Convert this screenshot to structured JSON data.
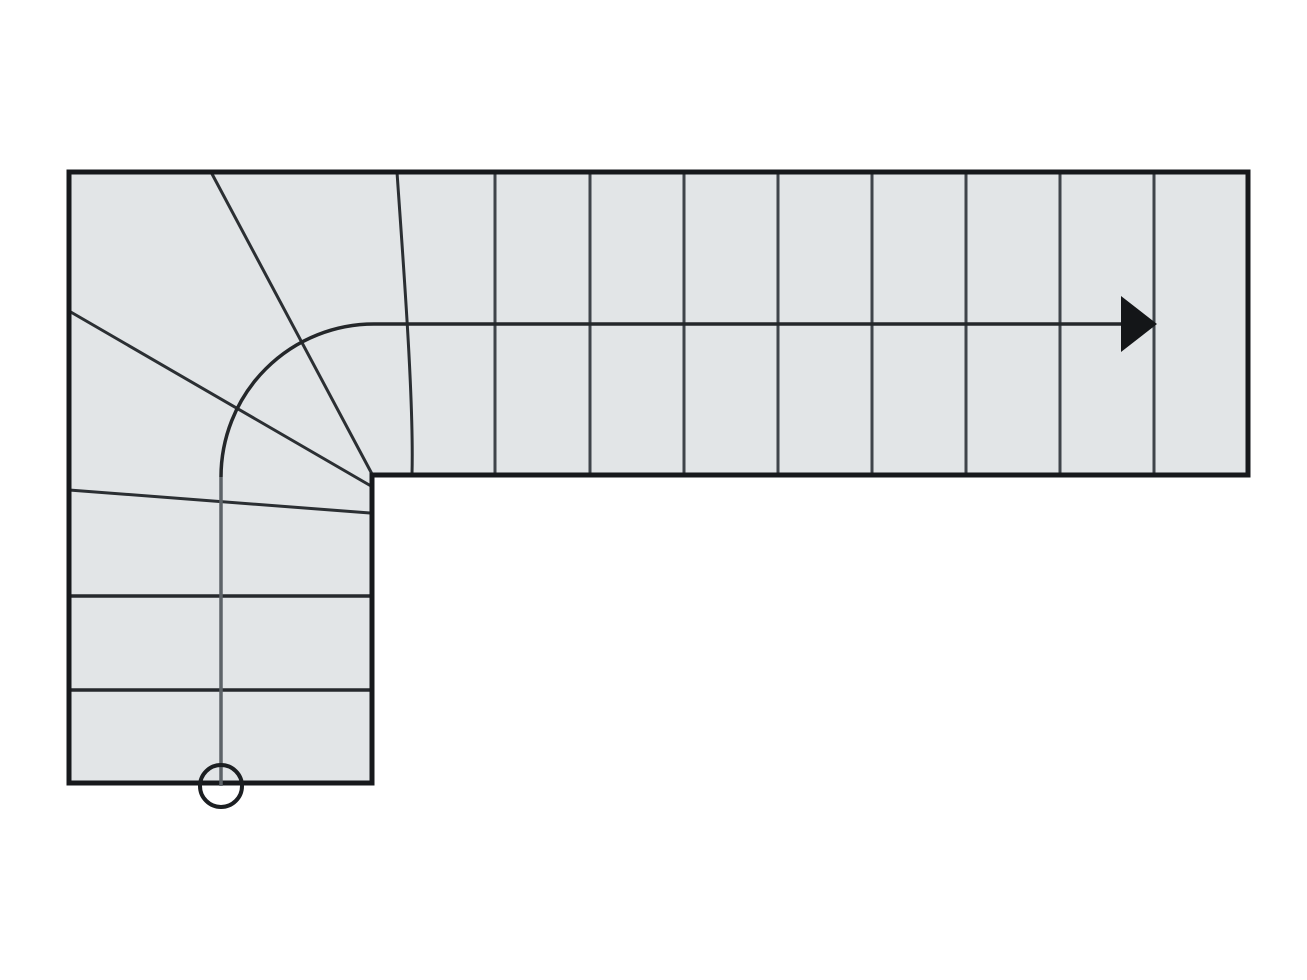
{
  "scene": {
    "description": "Plan view drawing of a quarter-turn (L-shaped) staircase with winder treads at the corner, walking line with direction arrow, and start-point circle",
    "background_color": "#ffffff",
    "canvas": {
      "width": 1307,
      "height": 980
    },
    "colors": {
      "stair_fill": "#e2e5e7",
      "outline": "#17191c",
      "upper_tread_line": "#3f444a",
      "lower_tread_line": "#26292d",
      "winder_line": "#2b2f33",
      "walk_line_vertical": "#5d6368",
      "walk_line_main": "#24272a",
      "arrowhead": "#141618",
      "start_circle": "#1c1f22"
    }
  },
  "stair": {
    "outline_points": "69,172 1248,172 1248,475 372,475 372,783 69,783",
    "outline_stroke_width": 5,
    "upper_flight": {
      "orientation": "horizontal",
      "tread_line_xs": [
        495,
        590,
        684,
        778,
        872,
        966,
        1060,
        1154
      ],
      "y_top": 172,
      "y_bottom": 475,
      "tread_line_width": 3,
      "tread_count": 9
    },
    "lower_flight": {
      "orientation": "vertical",
      "tread_line_ys": [
        596,
        690
      ],
      "x_left": 69,
      "x_right": 370,
      "tread_line_width": 3.5,
      "tread_count": 3
    },
    "winders": {
      "count": 4,
      "lines": [
        {
          "x1": 211,
          "y1": 172,
          "x2": 372,
          "y2": 474
        },
        {
          "x1": 69,
          "y1": 311,
          "x2": 371,
          "y2": 486
        },
        {
          "x1": 69,
          "y1": 490,
          "x2": 370,
          "y2": 513
        }
      ],
      "curve_path": "M 397 172 C 403 260 414 400 412 474",
      "line_width": 3
    },
    "walk_line": {
      "vertical_path": "M 221 786 L 221 477",
      "main_path": "M 221 477 A 153 153 0 0 1 374 324 L 1124 324",
      "width": 3.5,
      "direction": "up from start circle, quarter turn left-to-right, exit right"
    },
    "arrowhead": {
      "points": "1121,296 1157,324 1121,352"
    },
    "start_circle": {
      "cx": 221,
      "cy": 786,
      "r": 21,
      "stroke_width": 4
    }
  }
}
